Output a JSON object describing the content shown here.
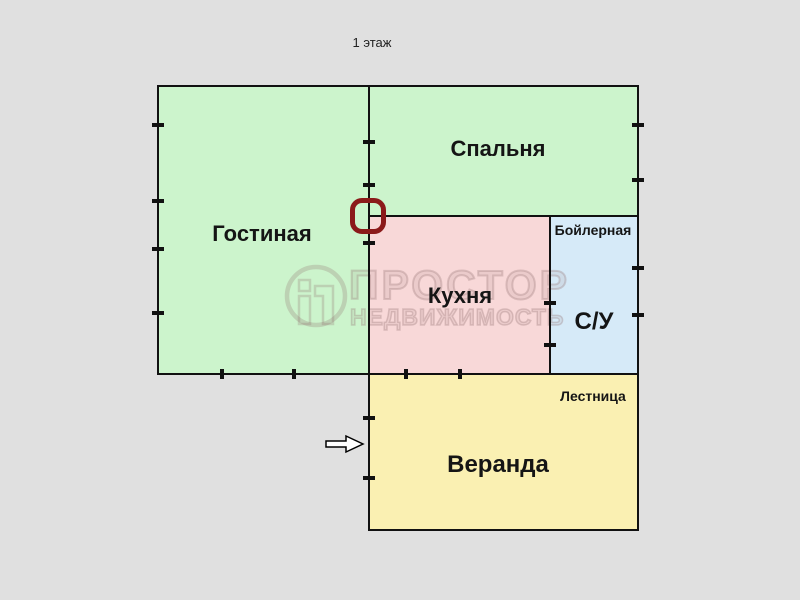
{
  "floor_title": "1 этаж",
  "rooms": {
    "living": {
      "label": "Гостиная",
      "color": "#ccf4cc"
    },
    "bedroom": {
      "label": "Спальня",
      "color": "#ccf4cc"
    },
    "kitchen": {
      "label": "Кухня",
      "color": "#f8d8d8"
    },
    "boiler": {
      "label": "Бойлерная",
      "color": "#d6eaf8"
    },
    "bathroom": {
      "label": "С/У",
      "color": "#d6eaf8"
    },
    "stairs": {
      "label": "Лестница",
      "color": "#faf0b2"
    },
    "veranda": {
      "label": "Веранда",
      "color": "#faf0b2"
    }
  },
  "watermark": {
    "brand": "ПРОСТОР",
    "subtitle": "НЕДВИЖИМОСТЬ"
  },
  "markers": {
    "door_marker_color": "#8b1a1a",
    "entrance_arrow_direction": "right"
  },
  "colors": {
    "background": "#e0e0e0",
    "wall": "#111111"
  }
}
